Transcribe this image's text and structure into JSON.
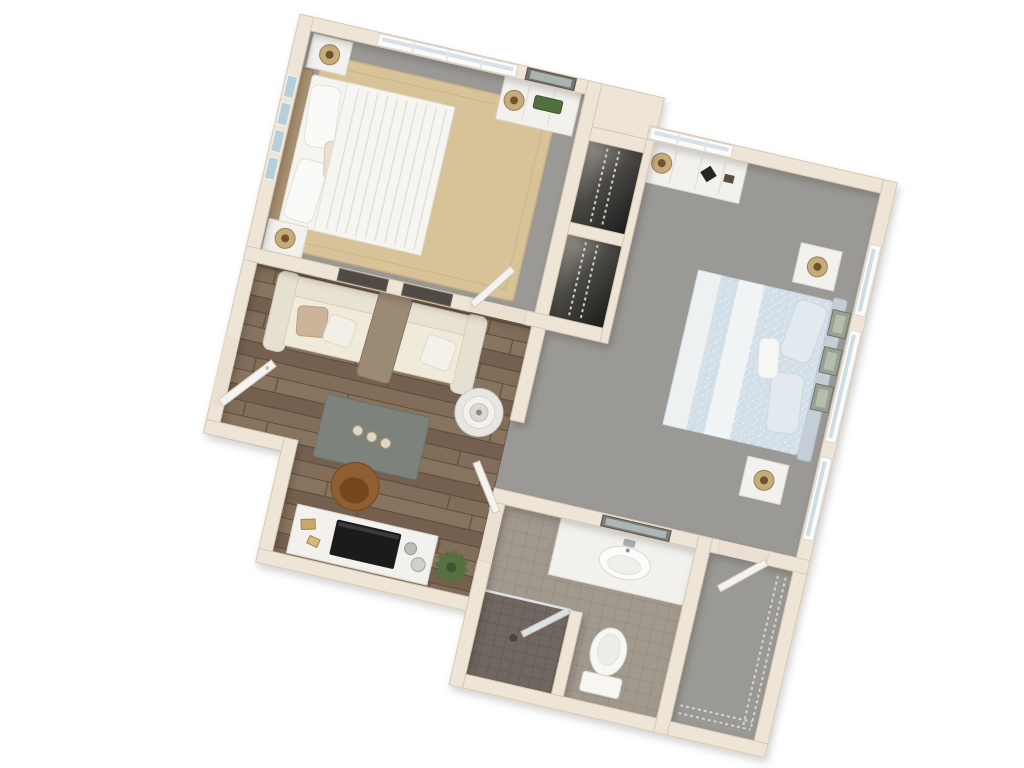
{
  "meta": {
    "title": "Two-bedroom one-bath apartment — 3D top-down floor plan render",
    "view": "3D dollhouse top-down view, plan rotated about 13 degrees clockwise",
    "background": "#FFFFFF"
  },
  "palette": {
    "wall": "#EEE5D7",
    "wall_edge": "#D6C9B2",
    "carpet": "#9B9995",
    "wood": "#7E6B5C",
    "rug": "#D8C298",
    "tile": "#A1988E",
    "shower": "#6F6760",
    "closet_dark": "#1C1C1C",
    "bed_white": "#F5F4F1",
    "bed_blue": "#D3DFE8",
    "sofa": "#E6E0D1",
    "throw_brown": "#9B8A74",
    "table_gray": "#7E827C",
    "console_white": "#F2F1EE",
    "tv_black": "#1B1B1B",
    "plant_green": "#55713F",
    "chair_brown": "#8F5F31",
    "door_white": "#F4F3F0",
    "gold": "#C6AC7C",
    "art_blue": "#B7CFDA"
  },
  "rooms": {
    "bedroom_1": {
      "label": "Bedroom 1",
      "flooring": "gray carpet with tan area rug",
      "furniture": [
        "queen bed with white striped bedding and two pillows",
        "wood headboard",
        "four blue wall-art canvases",
        "two white nightstands with gold lamps",
        "white dresser with gold lamp and greenery",
        "dark framed mirror over dresser",
        "large window on top wall",
        "open entry door"
      ]
    },
    "bedroom_2": {
      "label": "Bedroom 2",
      "flooring": "gray carpet",
      "furniture": [
        "bed with light-blue patterned bedding and white runner",
        "upholstered headboard on right wall",
        "three sage wall-art frames",
        "two white nightstands with gold lamps",
        "white dresser with lamp and black decor frame",
        "window on top wall",
        "three windows on right wall"
      ]
    },
    "living_room": {
      "label": "Living Room",
      "flooring": "brown wood planks",
      "furniture": [
        "cream sofa with tan and white pillows and brown throw",
        "two dark wall-art frames above sofa",
        "gray coffee table with three candles",
        "round side table with white lamp",
        "white front door (open)"
      ]
    },
    "media_area": {
      "label": "Media Wall",
      "furniture": [
        "white media console",
        "flat TV lying on console",
        "gold decor pieces",
        "two metallic spheres",
        "round brown saucer chair",
        "green potted plant"
      ]
    },
    "hall": {
      "label": "Hallway",
      "flooring": "gray carpet"
    },
    "hall_closets": {
      "label": "Hall Closets",
      "furniture": [
        "two reach-in closets with wire shelving, dark interiors"
      ]
    },
    "bathroom": {
      "label": "Bathroom",
      "flooring": "taupe tile",
      "furniture": [
        "white vanity with oval sink and faucet",
        "dark framed mirror",
        "toilet",
        "dark tiled walk-in shower with glass door and drain",
        "open door to living area"
      ]
    },
    "walk_in_closet": {
      "label": "Walk-in Closet",
      "flooring": "gray carpet",
      "furniture": [
        "wire shelving on right and bottom walls",
        "open white door"
      ]
    }
  }
}
